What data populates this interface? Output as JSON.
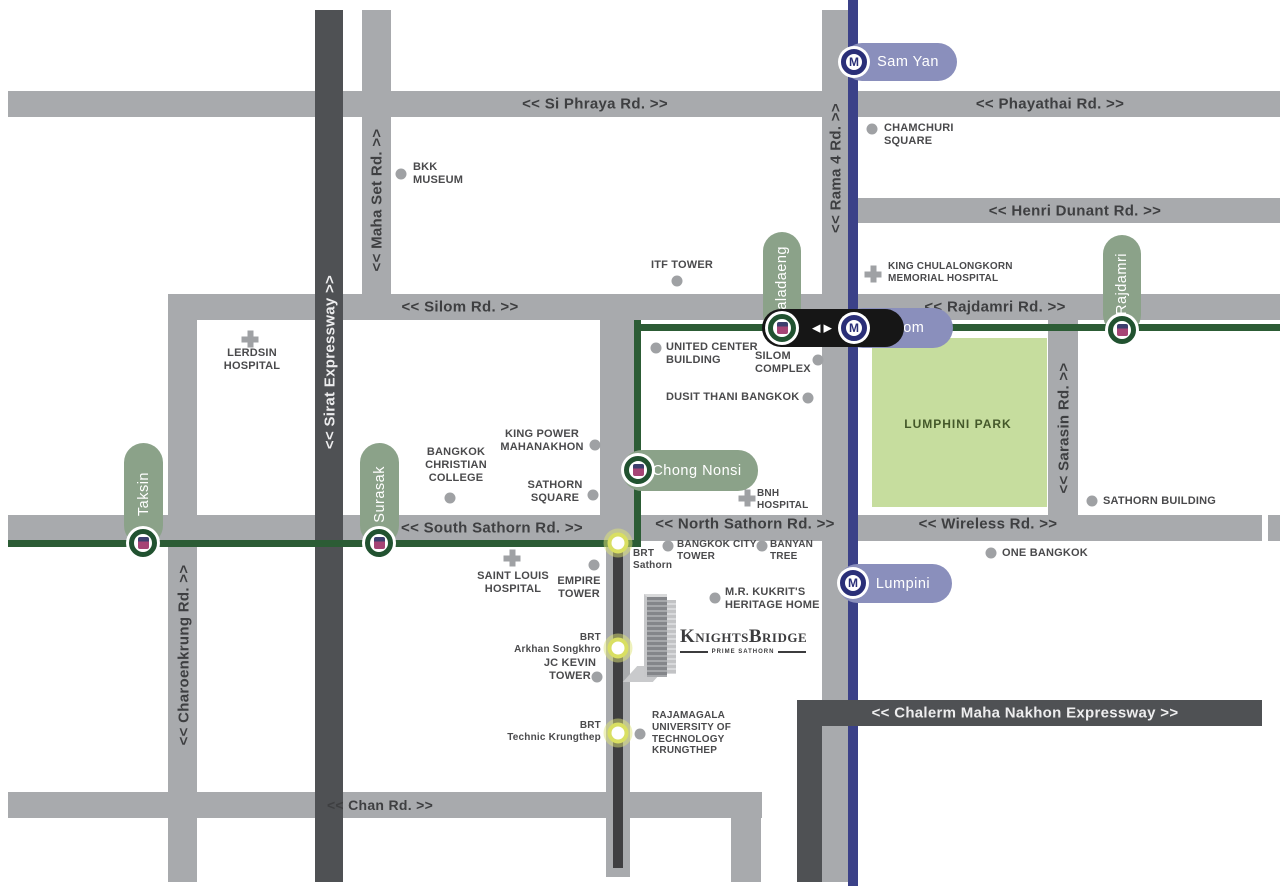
{
  "colors": {
    "road_gray": "#a8aaad",
    "expressway_dark": "#4f5154",
    "bts_pill_green": "#8ba289",
    "bts_line_green": "#2c5c35",
    "bts_ring_green": "#215230",
    "mrt_pill_purple": "#8a8fbc",
    "mrt_line_navy": "#3b4188",
    "mrt_ring_navy": "#2a2f78",
    "brt_ring_yellow": "#d9df62",
    "park_green": "#c6dd9e",
    "marker_gray": "#9fa1a4",
    "label_text": "#4a4a4c",
    "interchange_bar": "#161616"
  },
  "brand": {
    "wordmark": "KnightsBridge",
    "tagline": "PRIME SATHORN"
  },
  "park": {
    "name": "LUMPHINI PARK"
  },
  "roads": {
    "si_phraya": "<< Si Phraya Rd. >>",
    "phayathai": "<< Phayathai Rd. >>",
    "henri_dunant": "<< Henri Dunant Rd. >>",
    "silom": "<< Silom Rd. >>",
    "rajdamri": "<< Rajdamri Rd. >>",
    "south_sathorn": "<< South Sathorn Rd. >>",
    "north_sathorn": "<< North Sathorn Rd. >>",
    "wireless": "<< Wireless Rd. >>",
    "chan": "<< Chan Rd. >>",
    "charoenkrung": "<< Charoenkrung Rd. >>",
    "maha_set": "<< Maha Set Rd. >>",
    "sirat": "<< Sirat Expressway >>",
    "rama4": "<< Rama 4 Rd. >>",
    "sarasin": "<< Sarasin Rd. >>",
    "chalerm": "<< Chalerm Maha Nakhon Expressway >>"
  },
  "stations": {
    "bts": {
      "taksin": "Taksin",
      "surasak": "Surasak",
      "chong_nonsi": "Chong Nonsi",
      "saladaeng": "Saladaeng",
      "rajdamri": "Rajdamri"
    },
    "mrt": {
      "sam_yan": "Sam Yan",
      "silom": "Silom",
      "lumpini": "Lumpini",
      "logo_letter": "M"
    },
    "brt": {
      "sathorn": "BRT\nSathorn",
      "arkhan_songkhro": "BRT\nArkhan Songkhro",
      "technic_krungthep": "BRT\nTechnic Krungthep"
    }
  },
  "interchange": {
    "arrow_left": "◀",
    "arrow_right": "▶"
  },
  "landmarks": {
    "bkk_museum": "BKK\nMUSEUM",
    "chamchuri_square": "CHAMCHURI\nSQUARE",
    "itf_tower": "ITF TOWER",
    "king_chulalongkorn": "KING CHULALONGKORN\nMEMORIAL HOSPITAL",
    "lerdsin_hospital": "LERDSIN\nHOSPITAL",
    "united_center": "UNITED CENTER\nBUILDING",
    "silom_complex": "SILOM\nCOMPLEX",
    "dusit_thani": "DUSIT THANI BANGKOK",
    "king_power": "KING POWER\nMAHANAKHON",
    "bangkok_christian": "BANGKOK\nCHRISTIAN\nCOLLEGE",
    "sathorn_square": "SATHORN\nSQUARE",
    "bnh_hospital": "BNH\nHOSPITAL",
    "saint_louis": "SAINT LOUIS\nHOSPITAL",
    "empire_tower": "EMPIRE\nTOWER",
    "bangkok_city_tower": "BANGKOK CITY\nTOWER",
    "banyan_tree": "BANYAN\nTREE",
    "mr_kukrit": "M.R. KUKRIT'S\nHERITAGE HOME",
    "jc_kevin": "JC KEVIN\nTOWER",
    "rajamagala": "RAJAMAGALA\nUNIVERSITY OF\nTECHNOLOGY\nKRUNGTHEP",
    "sathorn_building": "SATHORN BUILDING",
    "one_bangkok": "ONE BANGKOK"
  }
}
